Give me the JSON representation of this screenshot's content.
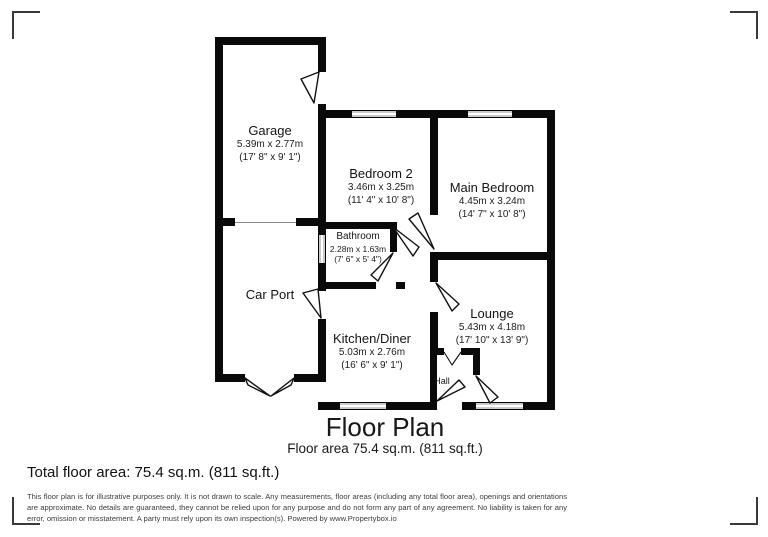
{
  "plan": {
    "title": "Floor Plan",
    "subtitle": "Floor area 75.4 sq.m. (811 sq.ft.)",
    "rooms": [
      {
        "name": "Garage",
        "dim_m": "5.39m x 2.77m",
        "dim_ft": "(17' 8\" x 9' 1\")"
      },
      {
        "name": "Bedroom 2",
        "dim_m": "3.46m x 3.25m",
        "dim_ft": "(11' 4\" x 10' 8\")"
      },
      {
        "name": "Main Bedroom",
        "dim_m": "4.45m x 3.24m",
        "dim_ft": "(14' 7\" x 10' 8\")"
      },
      {
        "name": "Bathroom",
        "dim_m": "2.28m x 1.63m",
        "dim_ft": "(7' 6\" x 5' 4\")"
      },
      {
        "name": "Car Port",
        "dim_m": "",
        "dim_ft": ""
      },
      {
        "name": "Kitchen/Diner",
        "dim_m": "5.03m x 2.76m",
        "dim_ft": "(16' 6\" x 9' 1\")"
      },
      {
        "name": "Lounge",
        "dim_m": "5.43m x 4.18m",
        "dim_ft": "(17' 10\" x 13' 9\")"
      },
      {
        "name": "Hall",
        "dim_m": "",
        "dim_ft": ""
      }
    ]
  },
  "footer": {
    "total_area": "Total floor area: 75.4 sq.m. (811 sq.ft.)",
    "disclaimer": "This floor plan is for illustrative purposes only. It is not drawn to scale. Any measurements, floor areas (including any total floor area), openings and orientations are approximate. No details are guaranteed, they cannot be relied upon for any purpose and do not form any part of any agreement. No liability is taken for any error, omission or misstatement. A party must rely upon its own inspection(s). Powered by www.Propertybox.io"
  },
  "colors": {
    "wall": "#0a0a0a",
    "window_fill": "#c9c9c9",
    "bracket": "#3a3a3a",
    "text": "#1c1c1c"
  }
}
